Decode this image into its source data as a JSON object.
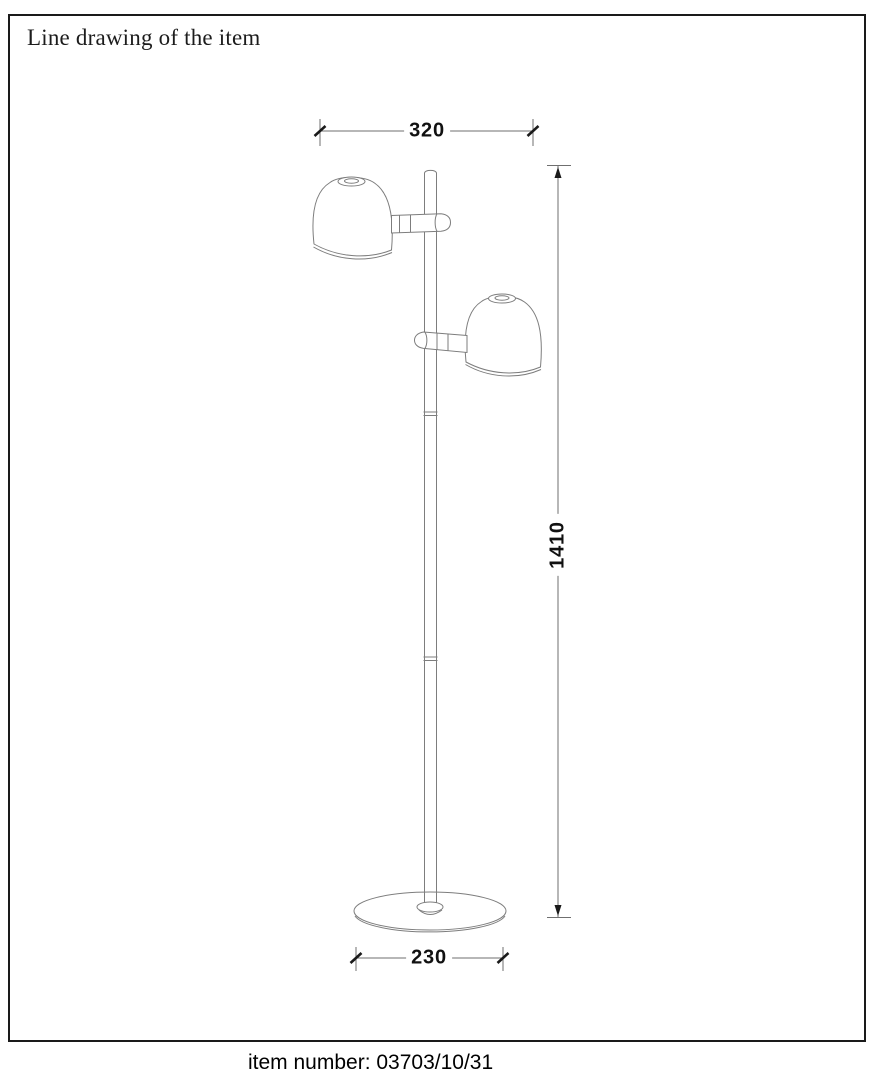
{
  "page": {
    "title": "Line drawing of the item",
    "footer": "item number: 03703/10/31"
  },
  "drawing": {
    "type": "technical-line-drawing",
    "subject": "floor-lamp-two-dome-spots-on-pole-with-round-base",
    "dimensions": {
      "width_top": "320",
      "height": "1410",
      "base_diameter": "230"
    }
  },
  "colors": {
    "background": "#ffffff",
    "border": "#1a1a1a",
    "line": "#7d7d7d",
    "dim_line": "#6f6f6f",
    "tick": "#1a1a1a",
    "text": "#111111"
  }
}
